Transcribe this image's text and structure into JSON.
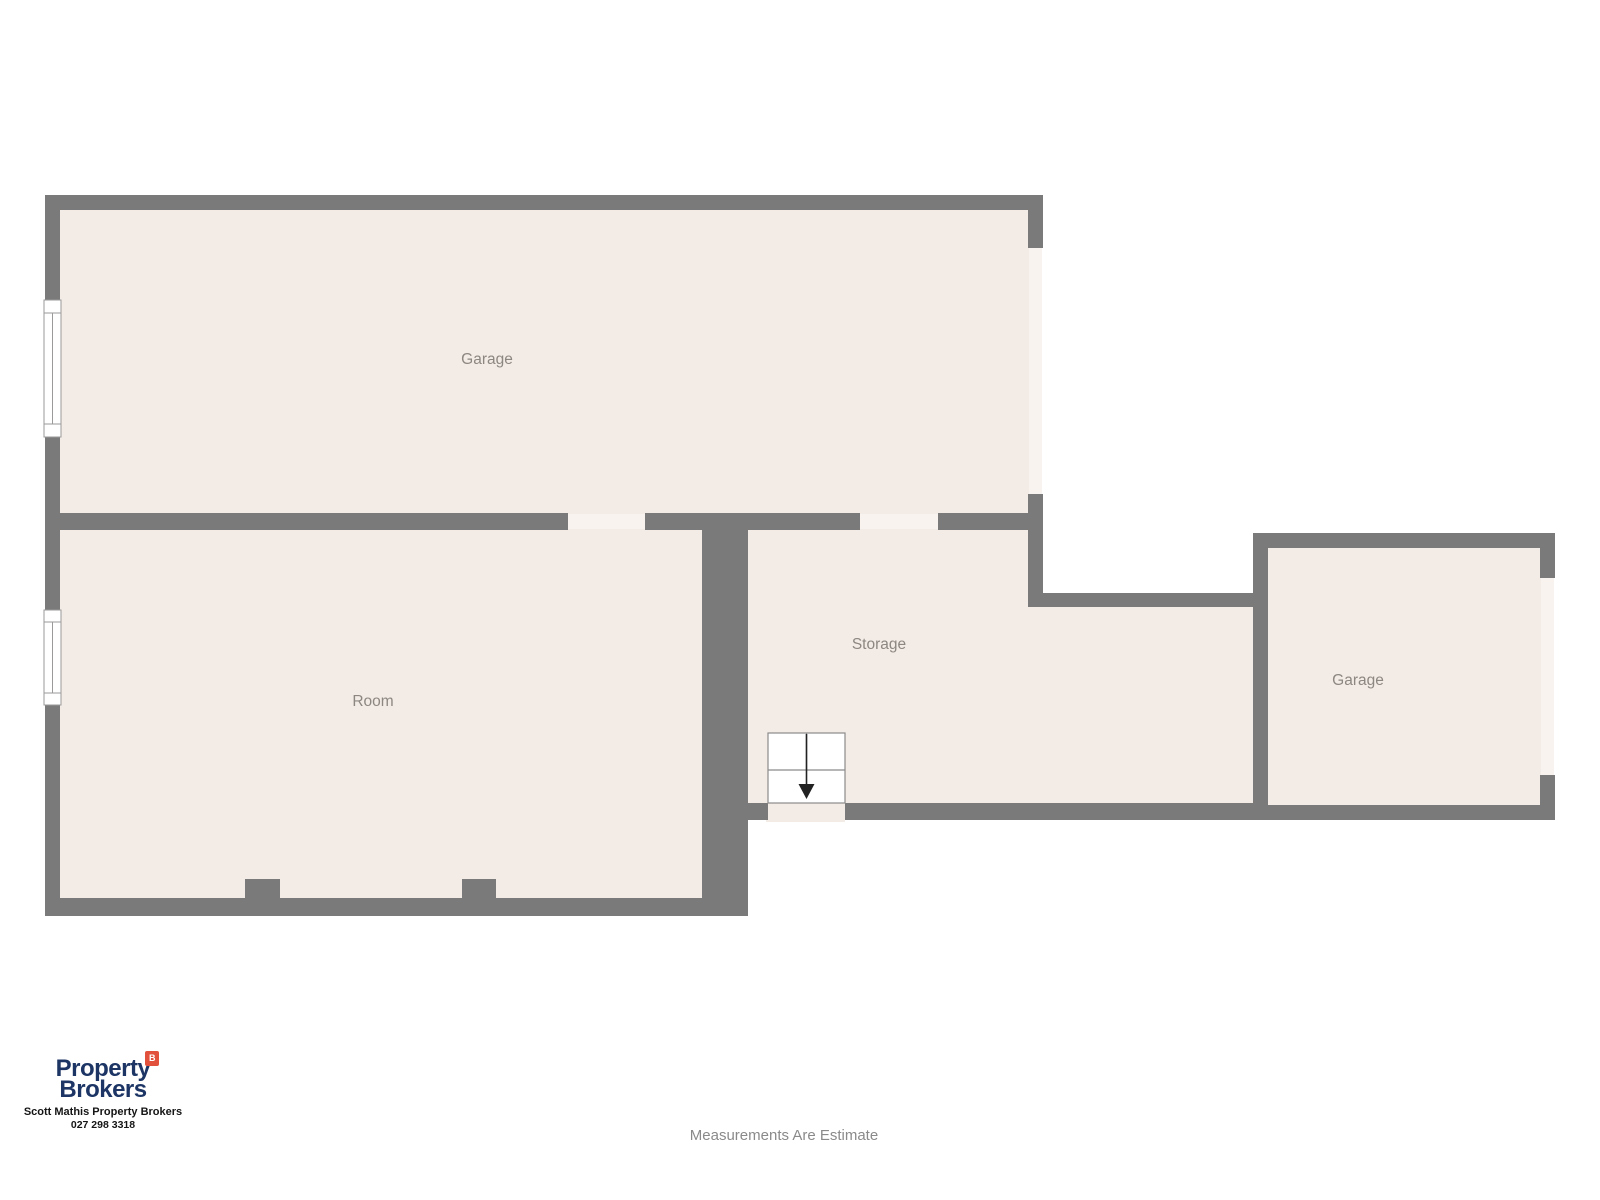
{
  "plan": {
    "rooms": [
      {
        "id": "garage-top",
        "label": "Garage"
      },
      {
        "id": "room",
        "label": "Room"
      },
      {
        "id": "storage",
        "label": "Storage"
      },
      {
        "id": "garage-right",
        "label": "Garage"
      }
    ],
    "symbols": {
      "stairs_icon": "stairs-down-arrow",
      "window_icon": "window",
      "door_opening_icon": "wall-opening"
    }
  },
  "branding": {
    "logo_line1": "Property",
    "logo_line2": "Brokers",
    "logo_badge": "B",
    "agent_line": "Scott Mathis Property Brokers",
    "phone": "027 298 3318"
  },
  "footer": {
    "disclaimer": "Measurements Are Estimate"
  },
  "colors": {
    "wall": "#7a7a7a",
    "floor": "#f3ece6",
    "door_opening": "#f8f3ee",
    "window_fill": "#ffffff",
    "label_text": "#8d8781",
    "brand_navy": "#1c3565",
    "brand_red": "#e2513b",
    "disclaimer_text": "#8a8a8a",
    "stairs_arrow": "#222222"
  }
}
